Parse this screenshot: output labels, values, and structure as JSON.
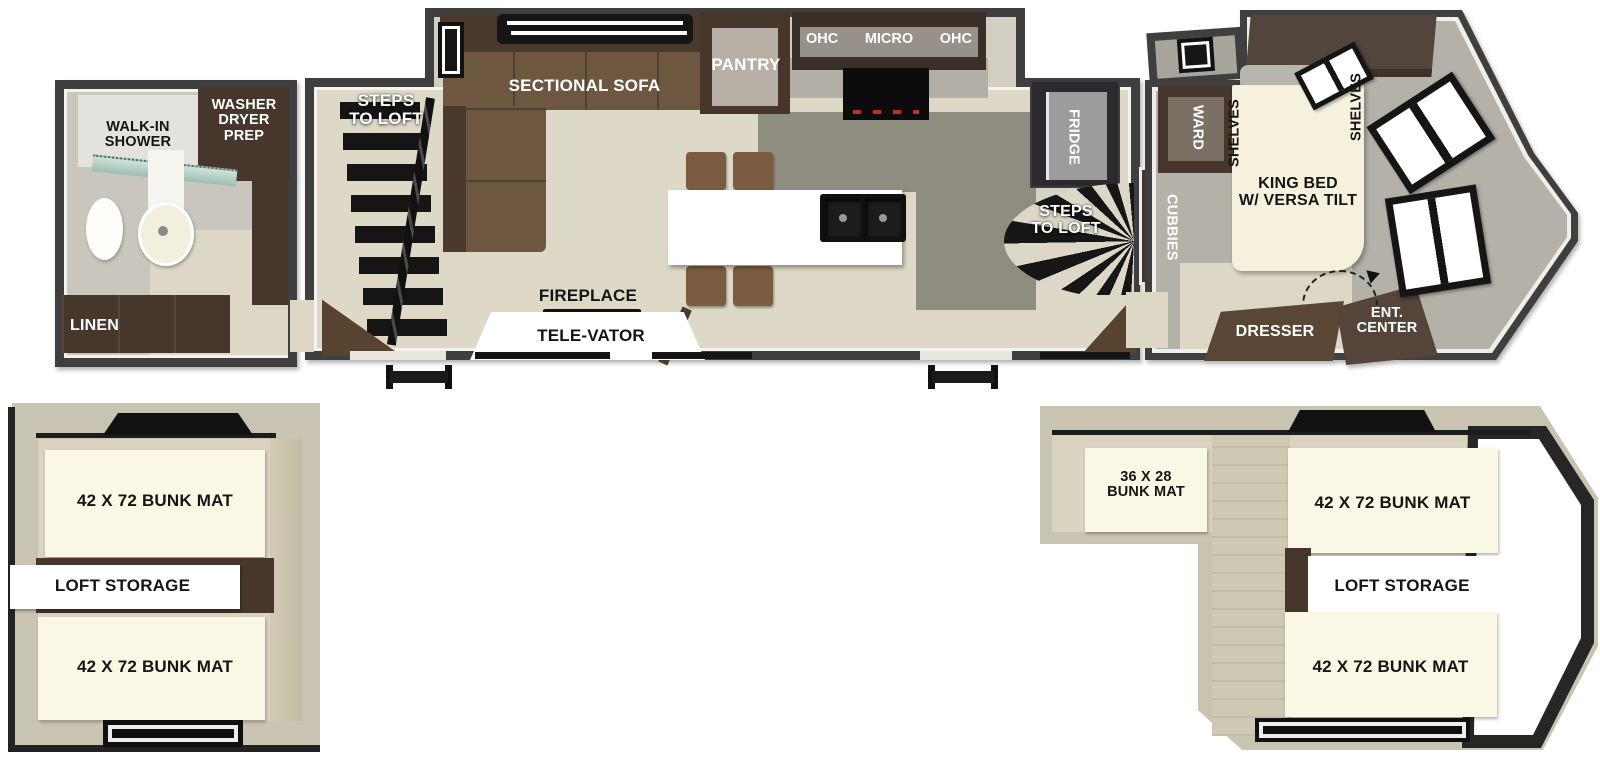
{
  "colors": {
    "wall": "#3f3f3f",
    "floor_wood": "#ded9c7",
    "floor_kitchen": "#8e8d80",
    "floor_bath": "#c9c6be",
    "floor_bedroom": "#b4b1a8",
    "cabinet_brown": "#46362b",
    "sofa_brown": "#6e5740",
    "mat_cream": "#fbf7e5",
    "loft_wall_tan": "#c9c4b2",
    "loft_floor": "#d9d3c0",
    "opening_black": "#161616"
  },
  "main_floor": {
    "bathroom": {
      "walk_in_shower": "WALK-IN\nSHOWER",
      "washer_dryer_prep": "WASHER\nDRYER\nPREP",
      "linen": "LINEN"
    },
    "living": {
      "steps_to_loft": "STEPS\nTO LOFT",
      "sectional_sofa": "SECTIONAL SOFA",
      "pantry": "PANTRY",
      "ohc_left": "OHC",
      "micro": "MICRO",
      "ohc_right": "OHC",
      "fridge": "FRIDGE",
      "steps_to_loft_spiral": "STEPS\nTO LOFT",
      "cubbies": "CUBBIES",
      "fireplace": "FIREPLACE",
      "tele_vator": "TELE-VATOR"
    },
    "bedroom": {
      "ward": "WARD",
      "shelves_left": "SHELVES",
      "shelves_right": "SHELVES",
      "king_bed": "KING BED\nW/ VERSA TILT",
      "dresser": "DRESSER",
      "ent_center": "ENT.\nCENTER"
    }
  },
  "loft_left": {
    "bunk_top": "42 X 72 BUNK MAT",
    "storage": "LOFT STORAGE",
    "bunk_bottom": "42 X 72 BUNK MAT"
  },
  "loft_right": {
    "bunk_small": "36 X 28\nBUNK MAT",
    "bunk_top": "42 X 72 BUNK MAT",
    "storage": "LOFT STORAGE",
    "bunk_bottom": "42 X 72 BUNK MAT"
  }
}
